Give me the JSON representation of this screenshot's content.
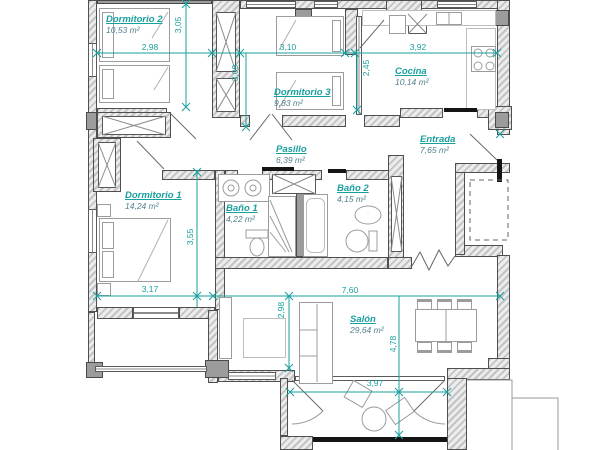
{
  "plan": {
    "colors": {
      "accent": "#18a09e",
      "area_text": "#4f7f8b",
      "wall_fill": "#c3c3c3",
      "door_leaf": "#141414"
    },
    "rooms": [
      {
        "name": "Dormitorio 2",
        "area": "10,53 m²"
      },
      {
        "name": "Dormitorio 3",
        "area": "9,83 m²"
      },
      {
        "name": "Cocina",
        "area": "10,14 m²"
      },
      {
        "name": "Pasillo",
        "area": "6,39 m²"
      },
      {
        "name": "Entrada",
        "area": "7,65 m²"
      },
      {
        "name": "Dormitorio 1",
        "area": "14,24 m²"
      },
      {
        "name": "Baño 1",
        "area": "4,22 m²"
      },
      {
        "name": "Baño 2",
        "area": "4,15 m²"
      },
      {
        "name": "Salón",
        "area": "29,64 m²"
      }
    ],
    "dims": {
      "d2_width": "2,98",
      "d2_height": "3,05",
      "d3_width": "3,10",
      "d3_height": "3,09",
      "cocina_width": "3,92",
      "cocina_height": "2,45",
      "d1_height": "3,55",
      "d1_width": "3,17",
      "salon_width": "7,60",
      "salon_left_height": "2,98",
      "salon_height": "4,78",
      "terraza_width": "3,97"
    }
  }
}
